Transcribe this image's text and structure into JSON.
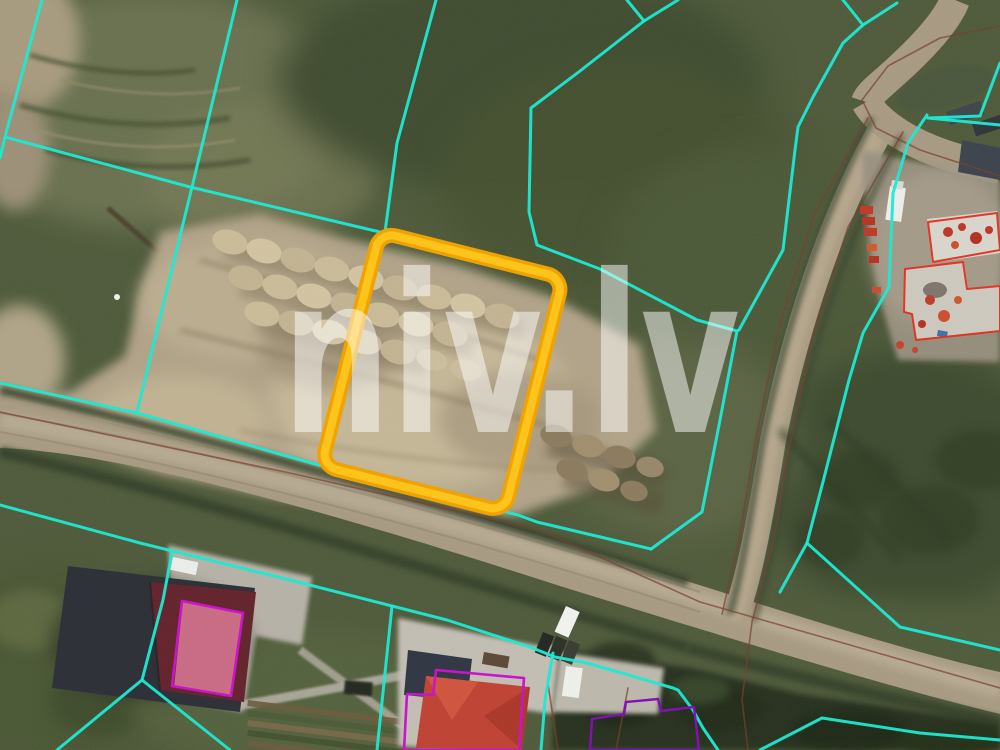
{
  "watermark": {
    "text": "niv.lv"
  },
  "colors": {
    "watermark_text": "rgba(255,255,255,0.5)",
    "cadastral_cyan": "#1de9d2",
    "road_line_brown": "#7a4030",
    "building_outline_red": "#e03020",
    "house_outline_magenta": "#c915c9",
    "planned_outline_purple": "#8012b4",
    "highlight_edge": "#efa303",
    "highlight_core": "#ffc41c"
  },
  "highlight_parcel": {
    "x": 380,
    "y": 232,
    "width": 189,
    "height": 241,
    "rotation_deg": 14.1,
    "corner_radius": 16,
    "edge_width": 15,
    "core_width": 8
  },
  "overlays": {
    "cyan_lines": [
      [
        [
          42,
          0
        ],
        [
          5,
          137
        ],
        [
          0,
          158
        ]
      ],
      [
        [
          5,
          137
        ],
        [
          190,
          187
        ],
        [
          380,
          232
        ]
      ],
      [
        [
          237,
          0
        ],
        [
          193,
          183
        ],
        [
          137,
          412
        ]
      ],
      [
        [
          436,
          0
        ],
        [
          397,
          143
        ],
        [
          385,
          232
        ]
      ],
      [
        [
          627,
          0
        ],
        [
          644,
          21
        ],
        [
          580,
          71
        ],
        [
          531,
          108
        ],
        [
          529,
          212
        ],
        [
          537,
          245
        ],
        [
          600,
          269
        ],
        [
          697,
          320
        ],
        [
          737,
          331
        ],
        [
          720,
          420
        ],
        [
          702,
          512
        ],
        [
          651,
          549
        ]
      ],
      [
        [
          678,
          0
        ],
        [
          644,
          21
        ]
      ],
      [
        [
          0,
          383
        ],
        [
          137,
          413
        ],
        [
          283,
          455
        ],
        [
          315,
          464
        ],
        [
          518,
          515
        ],
        [
          537,
          522
        ],
        [
          651,
          549
        ]
      ],
      [
        [
          0,
          505
        ],
        [
          140,
          543
        ],
        [
          290,
          580
        ],
        [
          447,
          620
        ],
        [
          530,
          647
        ],
        [
          555,
          657
        ],
        [
          587,
          663
        ],
        [
          673,
          688
        ],
        [
          678,
          690
        ],
        [
          693,
          710
        ],
        [
          703,
          728
        ],
        [
          718,
          750
        ]
      ],
      [
        [
          553,
          653
        ],
        [
          545,
          700
        ],
        [
          541,
          750
        ]
      ],
      [
        [
          392,
          606
        ],
        [
          377,
          750
        ]
      ],
      [
        [
          172,
          552
        ],
        [
          163,
          600
        ],
        [
          142,
          680
        ]
      ],
      [
        [
          142,
          680
        ],
        [
          57,
          750
        ]
      ],
      [
        [
          142,
          680
        ],
        [
          230,
          750
        ]
      ],
      [
        [
          843,
          0
        ],
        [
          863,
          25
        ],
        [
          843,
          43
        ],
        [
          813,
          97
        ],
        [
          798,
          127
        ],
        [
          795,
          150
        ],
        [
          783,
          250
        ],
        [
          739,
          330
        ],
        [
          737,
          331
        ]
      ],
      [
        [
          897,
          3
        ],
        [
          863,
          25
        ]
      ],
      [
        [
          927,
          115
        ],
        [
          908,
          143
        ],
        [
          893,
          193
        ],
        [
          889,
          287
        ],
        [
          863,
          333
        ],
        [
          849,
          380
        ],
        [
          824,
          478
        ],
        [
          807,
          543
        ],
        [
          900,
          627
        ],
        [
          1000,
          650
        ]
      ],
      [
        [
          928,
          118
        ],
        [
          1000,
          125
        ]
      ],
      [
        [
          1000,
          63
        ],
        [
          980,
          116
        ],
        [
          928,
          118
        ]
      ],
      [
        [
          807,
          543
        ],
        [
          780,
          592
        ]
      ],
      [
        [
          760,
          750
        ],
        [
          822,
          718
        ],
        [
          920,
          733
        ],
        [
          1000,
          740
        ]
      ]
    ],
    "brown_lines": [
      [
        [
          0,
          412
        ],
        [
          290,
          473
        ],
        [
          540,
          530
        ],
        [
          700,
          602
        ],
        [
          1000,
          688
        ]
      ],
      [
        [
          868,
          118
        ],
        [
          814,
          215
        ],
        [
          779,
          327
        ],
        [
          756,
          438
        ],
        [
          739,
          540
        ],
        [
          722,
          614
        ]
      ],
      [
        [
          903,
          132
        ],
        [
          848,
          227
        ],
        [
          813,
          335
        ],
        [
          790,
          444
        ],
        [
          773,
          544
        ],
        [
          752,
          622
        ],
        [
          742,
          700
        ],
        [
          748,
          750
        ]
      ],
      [
        [
          548,
          684
        ],
        [
          558,
          750
        ]
      ],
      [
        [
          628,
          688
        ],
        [
          616,
          750
        ]
      ],
      [
        [
          1000,
          26
        ],
        [
          940,
          38
        ],
        [
          888,
          66
        ],
        [
          862,
          100
        ],
        [
          876,
          128
        ],
        [
          920,
          150
        ],
        [
          1000,
          176
        ]
      ]
    ],
    "red_outlines": [
      [
        [
          928,
          222
        ],
        [
          997,
          213
        ],
        [
          1000,
          250
        ],
        [
          933,
          262
        ]
      ],
      [
        [
          905,
          269
        ],
        [
          963,
          262
        ],
        [
          967,
          289
        ],
        [
          1000,
          286
        ],
        [
          1000,
          331
        ],
        [
          916,
          340
        ],
        [
          912,
          314
        ],
        [
          904,
          312
        ]
      ]
    ],
    "magenta_outlines": [
      [
        [
          182,
          601
        ],
        [
          243,
          613
        ],
        [
          231,
          696
        ],
        [
          172,
          686
        ]
      ],
      [
        [
          436,
          670
        ],
        [
          524,
          678
        ],
        [
          519,
          750
        ],
        [
          404,
          750
        ],
        [
          407,
          694
        ],
        [
          433,
          695
        ]
      ]
    ],
    "purple_outlines": [
      [
        [
          590,
          750
        ],
        [
          592,
          719
        ],
        [
          624,
          714
        ],
        [
          626,
          702
        ],
        [
          658,
          699
        ],
        [
          661,
          711
        ],
        [
          694,
          707
        ],
        [
          699,
          750
        ]
      ]
    ]
  }
}
